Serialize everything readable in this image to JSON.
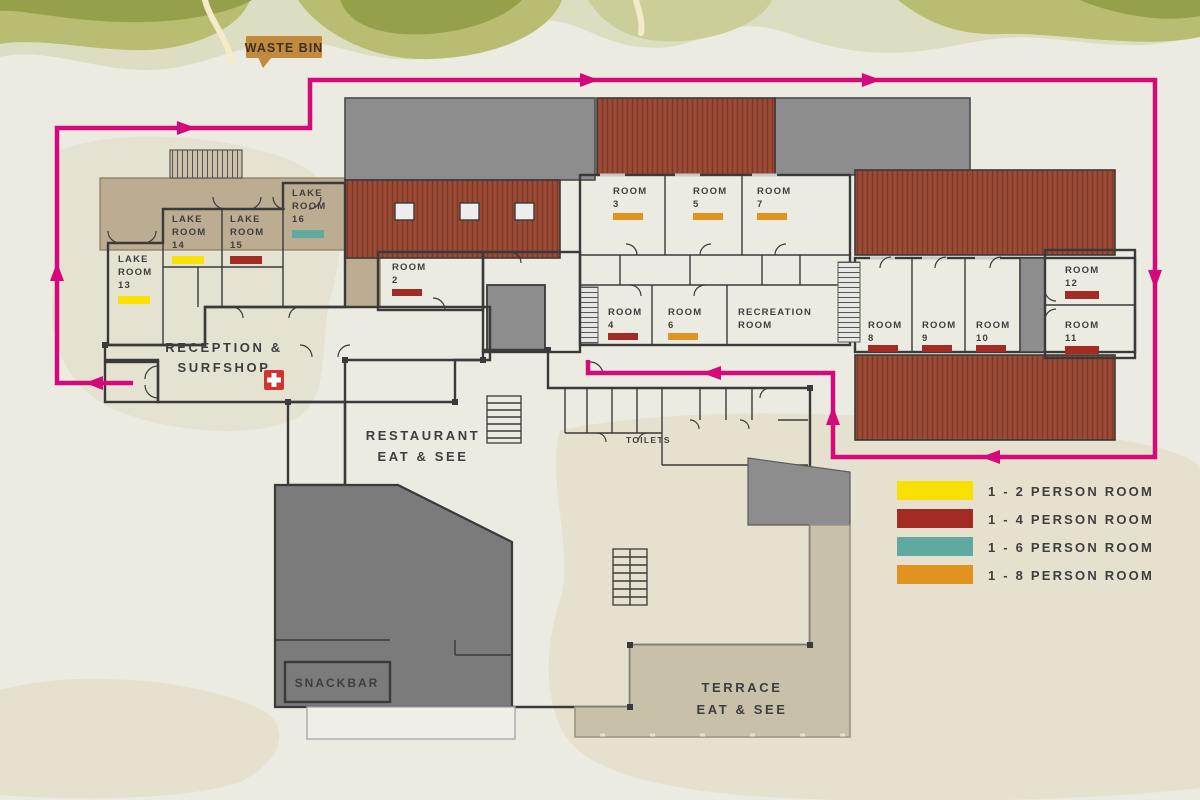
{
  "colors": {
    "path": "#D40A7C",
    "teal_area": "#74C0B8",
    "orange_area": "#F4A707",
    "waste_bin_bg": "#C18A3D",
    "first_aid_red": "#D1332E"
  },
  "waste_bin": {
    "label": "WASTE BIN"
  },
  "legend": [
    {
      "label": "1 - 2 PERSON ROOM",
      "color": "#F8E000"
    },
    {
      "label": "1 - 4 PERSON ROOM",
      "color": "#A22C24"
    },
    {
      "label": "1 - 6 PERSON ROOM",
      "color": "#5FA9A1"
    },
    {
      "label": "1 - 8 PERSON ROOM",
      "color": "#E0941F"
    }
  ],
  "areas": {
    "reception_line1": "RECEPTION &",
    "reception_line2": "SURFSHOP",
    "restaurant_line1": "RESTAURANT",
    "restaurant_line2": "EAT & SEE",
    "toilets": "TOILETS",
    "snackbar": "SNACKBAR",
    "terrace_line1": "TERRACE",
    "terrace_line2": "EAT & SEE",
    "recreation_line1": "RECREATION",
    "recreation_line2": "ROOM"
  },
  "rooms": {
    "lake13": {
      "l1": "LAKE",
      "l2": "ROOM",
      "l3": "13",
      "color": "#F8E000"
    },
    "lake14": {
      "l1": "LAKE",
      "l2": "ROOM",
      "l3": "14",
      "color": "#F8E000"
    },
    "lake15": {
      "l1": "LAKE",
      "l2": "ROOM",
      "l3": "15",
      "color": "#A22C24"
    },
    "lake16": {
      "l1": "LAKE",
      "l2": "ROOM",
      "l3": "16",
      "color": "#5FA9A1"
    },
    "r2": {
      "l1": "ROOM",
      "l2": "2",
      "color": "#A22C24"
    },
    "r3": {
      "l1": "ROOM",
      "l2": "3",
      "color": "#E0941F"
    },
    "r4": {
      "l1": "ROOM",
      "l2": "4",
      "color": "#A22C24"
    },
    "r5": {
      "l1": "ROOM",
      "l2": "5",
      "color": "#E0941F"
    },
    "r6": {
      "l1": "ROOM",
      "l2": "6",
      "color": "#E0941F"
    },
    "r7": {
      "l1": "ROOM",
      "l2": "7",
      "color": "#E0941F"
    },
    "r8": {
      "l1": "ROOM",
      "l2": "8",
      "color": "#A22C24"
    },
    "r9": {
      "l1": "ROOM",
      "l2": "9",
      "color": "#A22C24"
    },
    "r10": {
      "l1": "ROOM",
      "l2": "10",
      "color": "#A22C24"
    },
    "r11": {
      "l1": "ROOM",
      "l2": "11",
      "color": "#A22C24"
    },
    "r12": {
      "l1": "ROOM",
      "l2": "12",
      "color": "#A22C24"
    }
  }
}
